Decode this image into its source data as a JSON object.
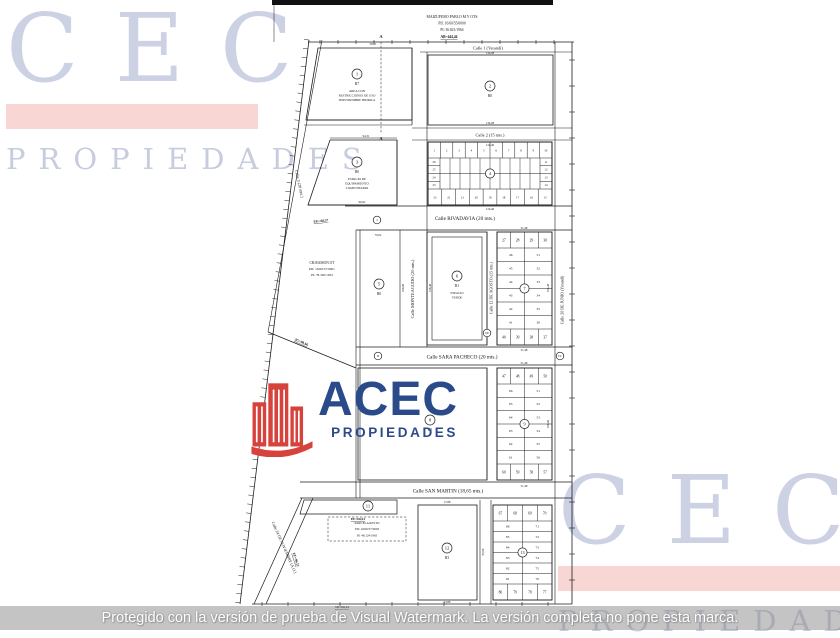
{
  "watermark_cec": {
    "text": "CEC",
    "sub": "PROPIEDADES",
    "letter_color": "#ccd1e4",
    "bar_color": "#f7d6d4"
  },
  "logo_acec": {
    "text": "ACEC",
    "sub": "PROPIEDADES",
    "text_color": "#2a4a8a",
    "icon": "buildings-icon",
    "icon_color": "#d6423c"
  },
  "protect_bar": {
    "text": "Protegido con la versión de prueba de Visual Watermark. La versión completa no pone esta marca."
  },
  "plan": {
    "title": {
      "l1": "MAIZUFERO PABLO M Y OTS",
      "l2": "PII: 16/60/55/0000",
      "l3": "PI: 36.821/1964",
      "l4": "AB=444,44"
    },
    "neighbor": {
      "l1": "CH.RAMON OT",
      "l2": "PII: 16/60/57/0001",
      "l3": "PI: 78.320/1952"
    },
    "streets": {
      "calle1": "Calle 1 (Yerandí)",
      "calle2": "Calle 2 (15 mts.)",
      "calle3": "Calle 3 (20 mts.)",
      "rivadavia": "Calle RIVADAVIA (20 mts.)",
      "sara_pacheco": "Calle SARA PACHECO (20 mts.)",
      "san_martin": "Calle SAN MARTIN (18,65 mts.)",
      "monteagudo": "Calle MONTEAGUDO (20 mts.)",
      "agosto12": "Calle 12 DE AGOSTO (15 mts.)",
      "junio20": "Calle 20 DE JUNIO (Yerandí)",
      "noviembre24": "Calle 24 DE NOVIEMBRE (A.O.)"
    },
    "parcels": [
      {
        "num": "1",
        "code": "B7",
        "note": [
          "AREA CON",
          "RESTRICCIONES DE USO",
          "SERVIDUMBRE HIDRICA"
        ],
        "cx": 357,
        "cy": 74
      },
      {
        "num": "2",
        "code": "B0",
        "note": [],
        "cx": 490,
        "cy": 86
      },
      {
        "num": "3",
        "code": "B0",
        "note": [
          "ESPACIO DE",
          "EQUIPAMIENTO",
          "COMUNITARIO"
        ],
        "cx": 357,
        "cy": 162
      },
      {
        "num": "5",
        "code": "B0",
        "note": [],
        "cx": 379,
        "cy": 284
      },
      {
        "num": "6",
        "code": "B1",
        "note": [
          "ESPACIO",
          "VERDE"
        ],
        "cx": 457,
        "cy": 276
      },
      {
        "num": "8",
        "code": "B2",
        "note": [],
        "cx": 430,
        "cy": 420
      },
      {
        "num": "11",
        "code": "",
        "note": [],
        "cx": 368,
        "cy": 506
      },
      {
        "num": "12",
        "code": "B3",
        "note": [],
        "cx": 447,
        "cy": 548
      }
    ],
    "blocks": [
      {
        "center": "4",
        "top": [
          "1",
          "2",
          "3",
          "4",
          "5",
          "6",
          "7",
          "8",
          "9",
          "10"
        ],
        "right": [
          "11",
          "12",
          "13",
          "14"
        ],
        "bottom": [
          "23",
          "22",
          "21",
          "20",
          "19",
          "18",
          "17",
          "16",
          "15"
        ],
        "left": [
          "26",
          "25",
          "24",
          "23"
        ]
      },
      {
        "center": "7",
        "top": [
          "27",
          "28",
          "29",
          "30"
        ],
        "right": [
          "31",
          "32",
          "33",
          "34",
          "35",
          "36"
        ],
        "bottom": [
          "40",
          "39",
          "38",
          "37"
        ],
        "left": [
          "46",
          "45",
          "44",
          "43",
          "42",
          "41"
        ]
      },
      {
        "center": "9",
        "top": [
          "47",
          "48",
          "49",
          "50"
        ],
        "right": [
          "51",
          "52",
          "53",
          "54",
          "55",
          "56"
        ],
        "bottom": [
          "60",
          "59",
          "58",
          "57"
        ],
        "left": [
          "66",
          "65",
          "64",
          "63",
          "62",
          "61"
        ]
      },
      {
        "center": "13",
        "top": [
          "67",
          "68",
          "69",
          "70"
        ],
        "right": [
          "71",
          "72",
          "73",
          "74",
          "75",
          "76"
        ],
        "bottom": [
          "80",
          "79",
          "78",
          "77"
        ],
        "left": [
          "86",
          "85",
          "84",
          "83",
          "82",
          "81"
        ]
      }
    ],
    "monuments": [
      {
        "t": "I",
        "x": 377,
        "y": 220
      },
      {
        "t": "II",
        "x": 378,
        "y": 356
      },
      {
        "t": "III",
        "x": 487,
        "y": 333
      },
      {
        "t": "IV",
        "x": 560,
        "y": 356
      }
    ],
    "markers": [
      {
        "t": "A",
        "x": 381,
        "y": 38
      },
      {
        "t": "A",
        "x": 381,
        "y": 140
      }
    ],
    "note_block": [
      "PARCELA RESTO",
      "PII: 16/60/57/0002",
      "PI: 48.124/1965"
    ],
    "measurements": [
      {
        "t": "EG=68,37",
        "x": 321,
        "y": 222,
        "r": -6
      },
      {
        "t": "2G=90,66",
        "x": 301,
        "y": 343,
        "r": 24
      },
      {
        "t": "EF=68,01",
        "x": 358,
        "y": 520,
        "r": 0
      },
      {
        "t": "SD=68,14",
        "x": 342,
        "y": 608,
        "r": 0
      },
      {
        "t": "EF=96,12",
        "x": 295,
        "y": 560,
        "r": 72
      }
    ],
    "dims": [
      {
        "t": "58,01",
        "x": 373,
        "y": 45
      },
      {
        "t": "134,08",
        "x": 490,
        "y": 54
      },
      {
        "t": "134,08",
        "x": 490,
        "y": 124
      },
      {
        "t": "110,46",
        "x": 490,
        "y": 146
      },
      {
        "t": "110,46",
        "x": 490,
        "y": 210
      },
      {
        "t": "94,31",
        "x": 366,
        "y": 137
      },
      {
        "t": "96,62",
        "x": 362,
        "y": 203
      },
      {
        "t": "51,48",
        "x": 524,
        "y": 229
      },
      {
        "t": "51,48",
        "x": 524,
        "y": 351
      },
      {
        "t": "51,48",
        "x": 524,
        "y": 364
      },
      {
        "t": "51,48",
        "x": 524,
        "y": 487
      },
      {
        "t": "70,02",
        "x": 378,
        "y": 236
      },
      {
        "t": "53,88",
        "x": 447,
        "y": 603
      },
      {
        "t": "17,88",
        "x": 447,
        "y": 503
      },
      {
        "t": "100,08",
        "x": 404,
        "y": 288,
        "r": -90
      },
      {
        "t": "106,48",
        "x": 549,
        "y": 288,
        "r": -90
      },
      {
        "t": "108,66",
        "x": 549,
        "y": 424,
        "r": -90
      },
      {
        "t": "95,08",
        "x": 484,
        "y": 552,
        "r": -90
      },
      {
        "t": "128,48",
        "x": 431,
        "y": 288,
        "r": -90
      }
    ]
  }
}
